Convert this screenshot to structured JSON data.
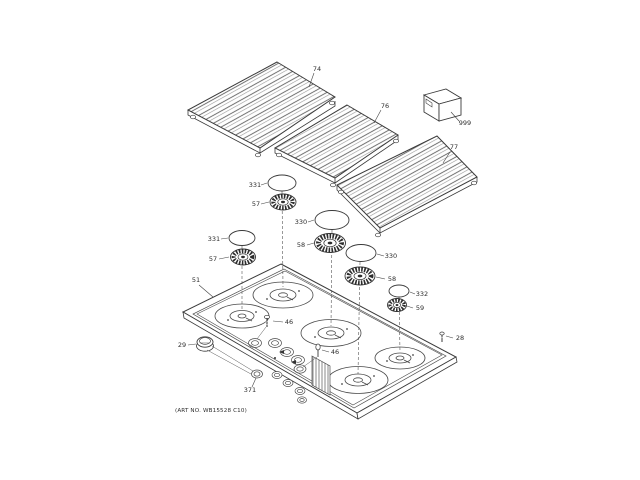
{
  "art_no": "(ART NO. WB15528 C10)",
  "colors": {
    "ink": "#2d2d2d",
    "line": "#4a4a4a",
    "background": "#ffffff"
  },
  "parts": {
    "grate_left": {
      "label": "74"
    },
    "grate_center": {
      "label": "76"
    },
    "grate_right": {
      "label": "77"
    },
    "literature_box": {
      "label": "999"
    },
    "cap_331_top": {
      "label": "331"
    },
    "burner_57_top": {
      "label": "57"
    },
    "cap_330_top": {
      "label": "330"
    },
    "cap_331_left": {
      "label": "331"
    },
    "burner_57_left": {
      "label": "57"
    },
    "burner_58_center": {
      "label": "58"
    },
    "cap_330_right": {
      "label": "330"
    },
    "burner_58_right": {
      "label": "58"
    },
    "cap_332": {
      "label": "332"
    },
    "burner_59": {
      "label": "59"
    },
    "maintop": {
      "label": "51"
    },
    "knob": {
      "label": "29"
    },
    "screw_46_top": {
      "label": "46"
    },
    "valve_pin_46": {
      "label": "46"
    },
    "screw_28": {
      "label": "28"
    },
    "ring_371": {
      "label": "371"
    }
  }
}
